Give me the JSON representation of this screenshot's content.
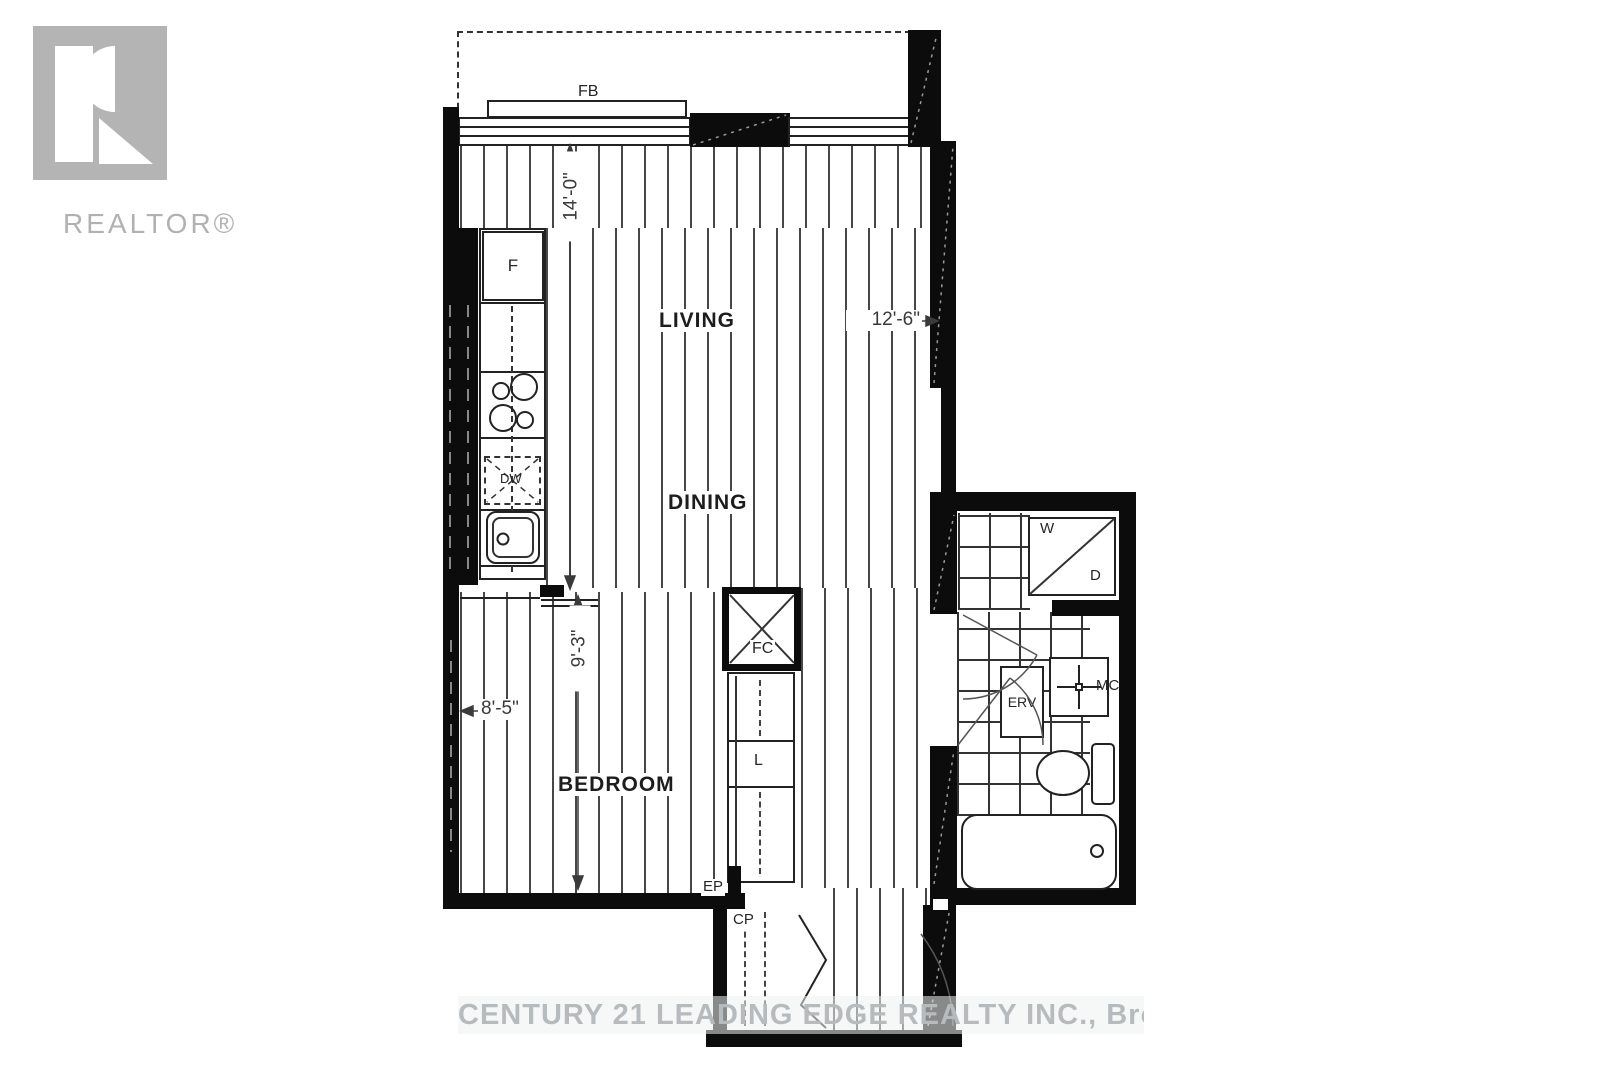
{
  "branding": {
    "logo_wordmark": "REALTOR®",
    "watermark": "CENTURY 21 LEADING EDGE REALTY INC., Brokerage"
  },
  "rooms": {
    "living": "LIVING",
    "dining": "DINING",
    "bedroom": "BEDROOM"
  },
  "dimensions": {
    "living_length": "14'-0\"",
    "living_width": "12'-6\"",
    "bedroom_length": "9'-3\"",
    "bedroom_width": "8'-5\""
  },
  "fixtures": {
    "balcony_door": "FB",
    "fridge": "F",
    "dishwasher": "DW",
    "foyer_closet": "FC",
    "linen_closet": "L",
    "electrical_panel": "EP",
    "coat_closet": "CP",
    "washer": "W",
    "dryer": "D",
    "erv": "ERV",
    "medicine_cabinet": "MC"
  },
  "colors": {
    "wall": "#0c0c0c",
    "logo_gray": "#b4b4b4",
    "watermark_text": "#b6bcbe"
  }
}
